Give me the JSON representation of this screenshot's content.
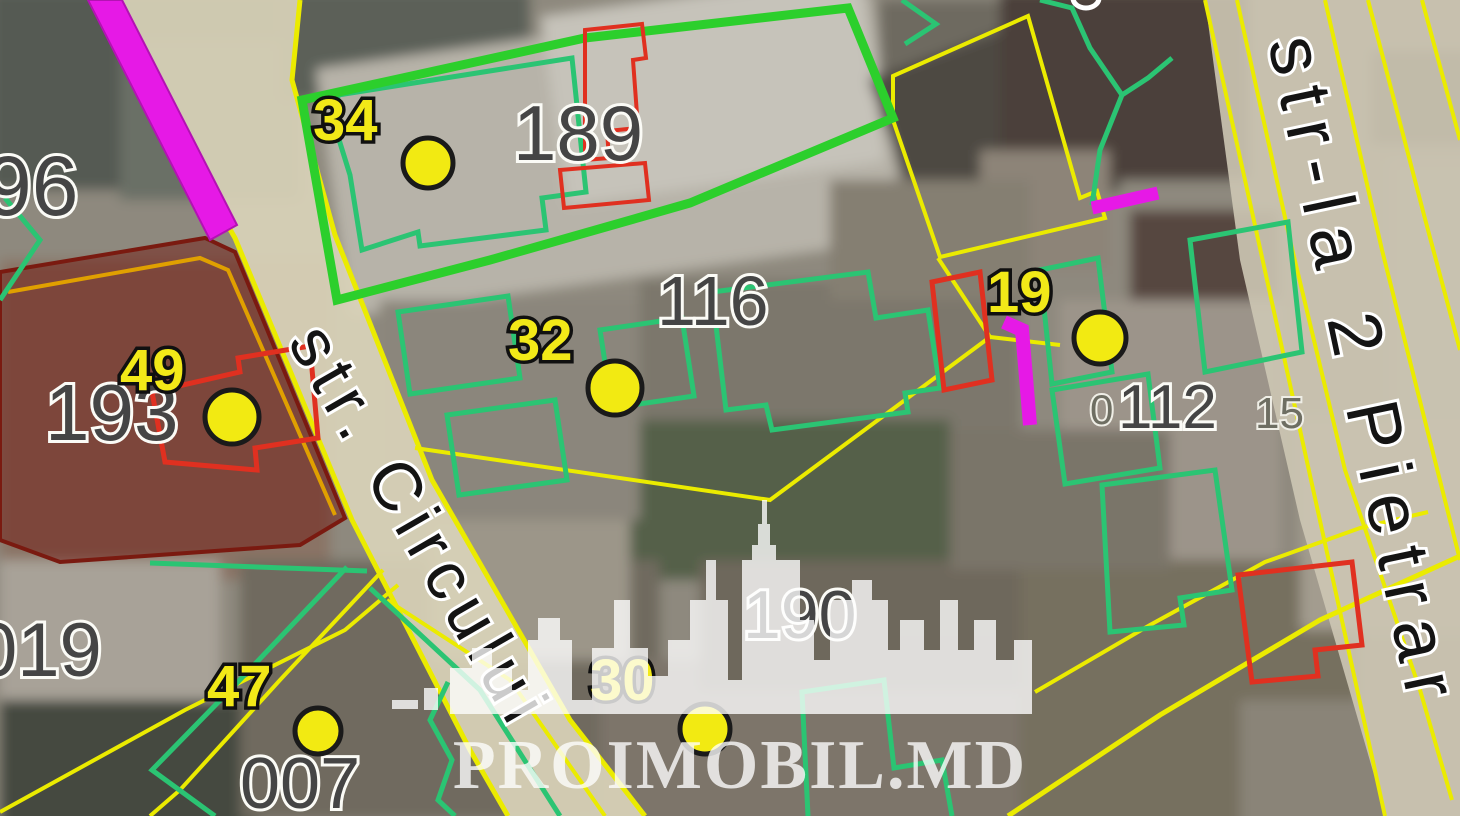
{
  "watermark": {
    "text": "PROIMOBIL.MD"
  },
  "streets": {
    "left": "str. Circului",
    "right": "str-la 2 Pietrar"
  },
  "parcels": [
    {
      "id": "96"
    },
    {
      "id": "189"
    },
    {
      "id": "116"
    },
    {
      "id": "193"
    },
    {
      "id": "019"
    },
    {
      "id": "007"
    },
    {
      "id": "190"
    },
    {
      "id": "112"
    },
    {
      "id": "0"
    },
    {
      "id": "15"
    }
  ],
  "markers": [
    {
      "label": "34"
    },
    {
      "label": "32"
    },
    {
      "label": "19"
    },
    {
      "label": "49"
    },
    {
      "label": "47"
    },
    {
      "label": "30"
    }
  ],
  "colors": {
    "parcel_boundary_yellow": "#ebeb00",
    "selected_parcel_green": "#2ccf2c",
    "building_outline_teal": "#2bc473",
    "restriction_red": "#e03020",
    "utility_magenta": "#e619e6",
    "zone_maroon_fill": "rgba(112,26,18,0.5)",
    "marker_fill": "#f2ea12",
    "road_fill": "#d9d2b8"
  }
}
